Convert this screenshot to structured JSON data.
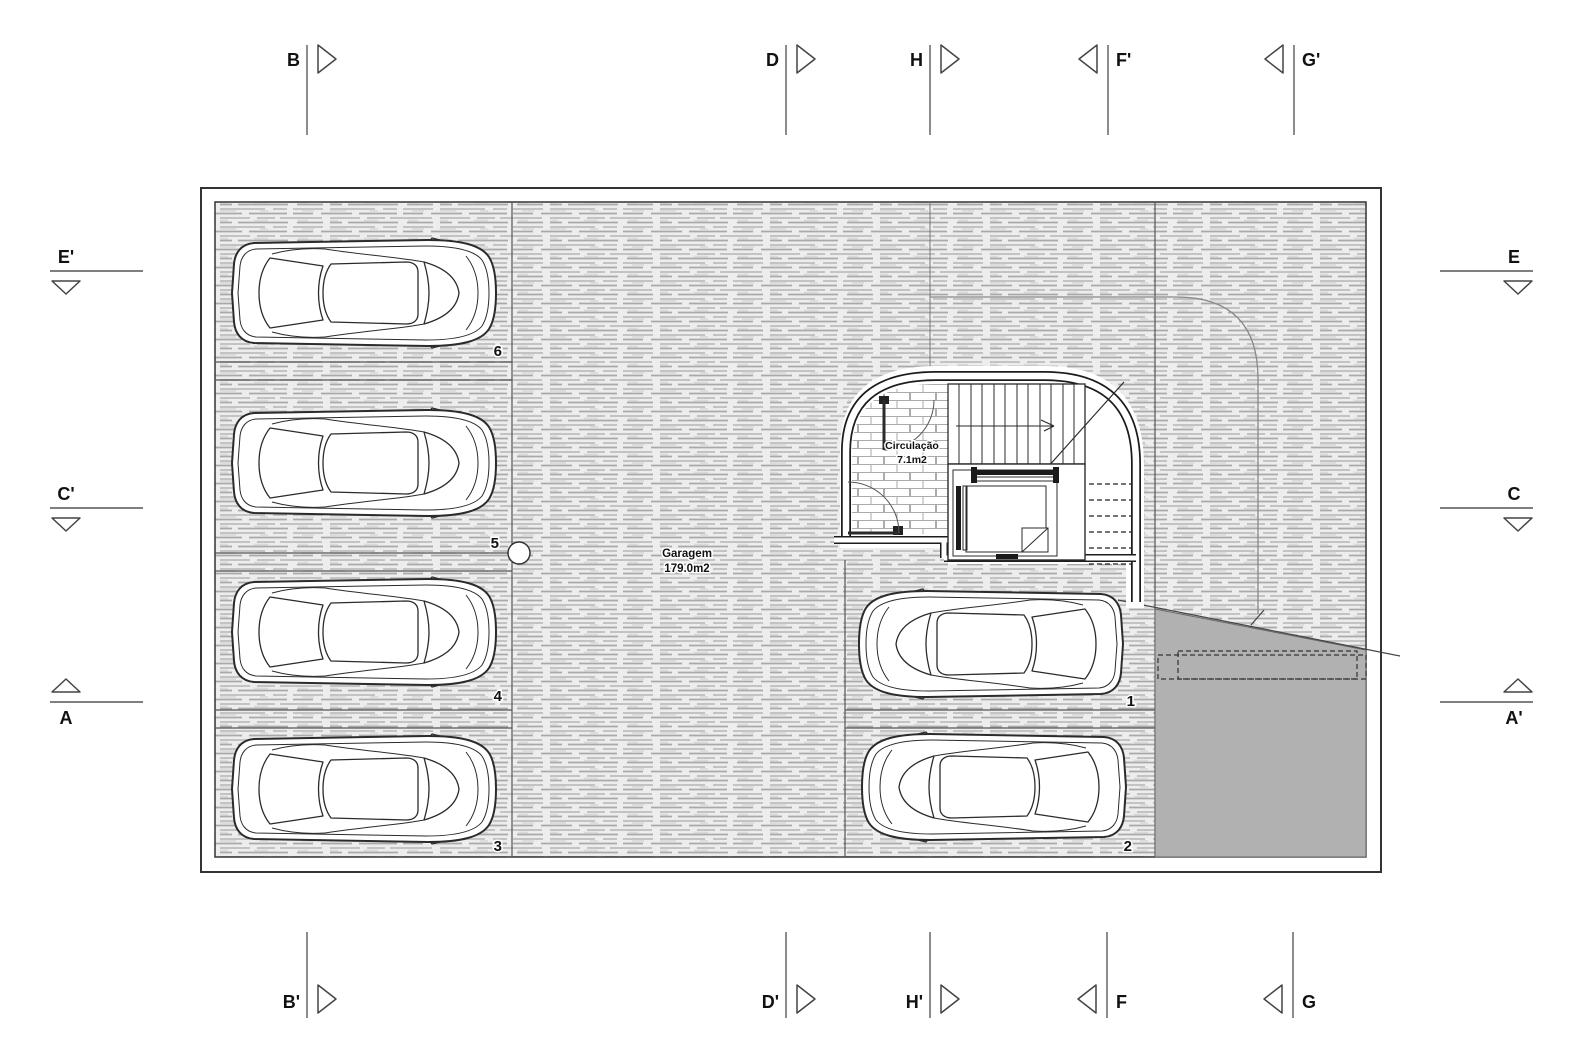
{
  "plan": {
    "rooms": [
      {
        "name": "Garagem",
        "area": "179.0m2"
      },
      {
        "name": "Circulação",
        "area": "7.1m2"
      }
    ],
    "stall_numbers": [
      "1",
      "2",
      "3",
      "4",
      "5",
      "6"
    ],
    "grid": {
      "top": [
        "B",
        "D",
        "H",
        "F'",
        "G'"
      ],
      "bottom": [
        "B'",
        "D'",
        "H'",
        "F",
        "G"
      ],
      "left": [
        "E'",
        "C'",
        "A"
      ],
      "right": [
        "E",
        "C",
        "A'"
      ]
    },
    "colors": {
      "ink": "#2b2b2b",
      "hatch_line": "#b9b9b9",
      "ramp_fill": "#b1b1b1"
    }
  }
}
